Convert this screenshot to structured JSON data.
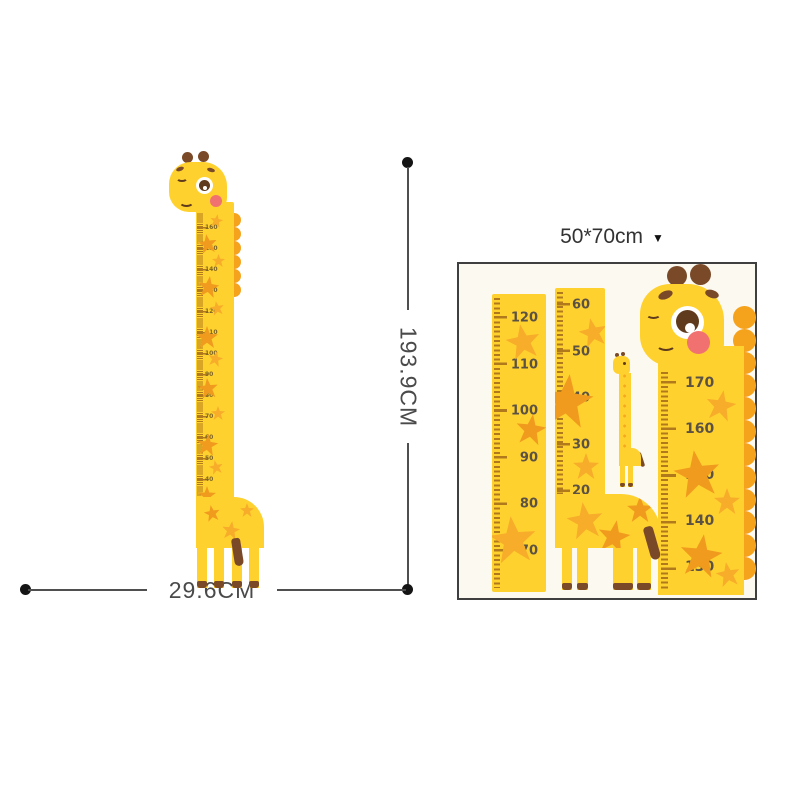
{
  "left_figure": {
    "height_label": "193.9CM",
    "width_label": "29.6CM",
    "ruler_numbers": [
      "170",
      "160",
      "150",
      "140",
      "130",
      "120",
      "110",
      "100",
      "90",
      "80",
      "70",
      "60",
      "50",
      "40",
      "30",
      "20",
      "10"
    ]
  },
  "size_selector": {
    "label": "50*70cm",
    "dropdown_icon": "▼"
  },
  "panel": {
    "left_ruler_numbers": [
      "120",
      "110",
      "100",
      "90",
      "80",
      "70"
    ],
    "middle_ruler_numbers": [
      "60",
      "50",
      "40",
      "30",
      "20",
      "10"
    ],
    "right_ruler_numbers": [
      "170",
      "160",
      "150",
      "140",
      "130"
    ]
  },
  "colors": {
    "yellow": "#FFD12F",
    "orange": "#F5A21D",
    "star": "#F7AC2A",
    "star_deep": "#F09B1E",
    "brown": "#7A4A28",
    "brown_dark": "#5F3A1C",
    "pink": "#F17170",
    "tick": "#B0791B",
    "number": "#5C5244",
    "line": "#4F4F4F",
    "panel_border": "#3F3F3F",
    "panel_bg": "#FCF9F1",
    "label": "#4A4A4A"
  }
}
